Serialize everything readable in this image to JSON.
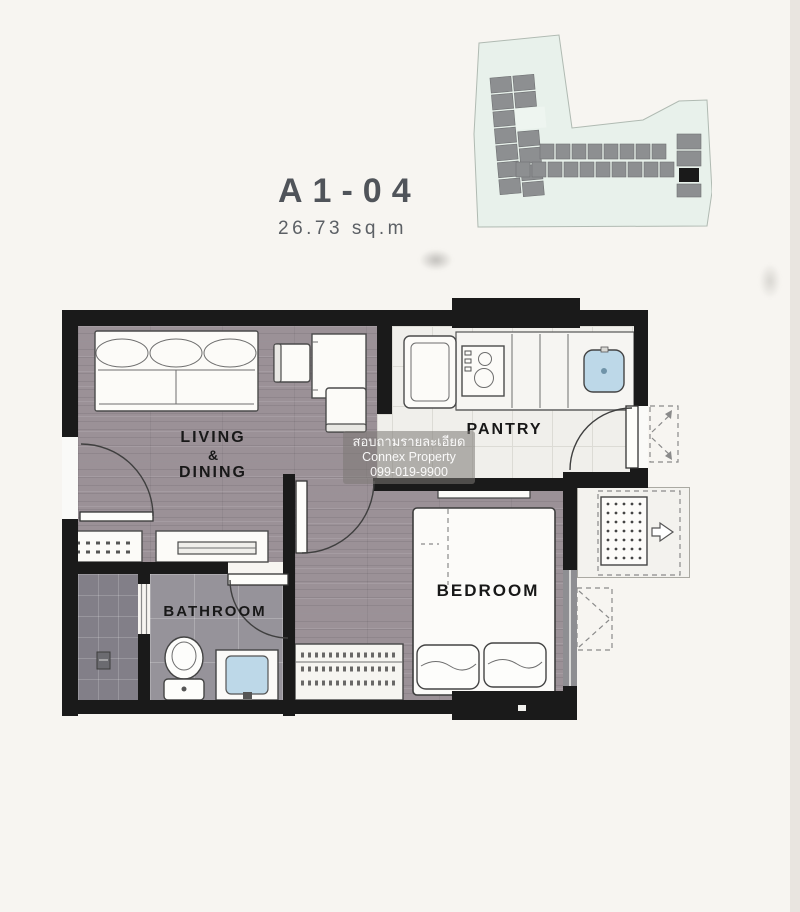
{
  "unit": {
    "code": "A1-04",
    "area": "26.73 sq.m"
  },
  "rooms": {
    "living": {
      "lines": [
        "LIVING",
        "&",
        "DINING"
      ]
    },
    "pantry": {
      "label": "PANTRY"
    },
    "bedroom": {
      "label": "BEDROOM"
    },
    "bathroom": {
      "label": "BATHROOM"
    }
  },
  "watermark": {
    "lines": [
      "สอบถามรายละเอียด",
      "Connex Property",
      "099-019-9900"
    ]
  },
  "palette": {
    "wall": "#1a1a1a",
    "wood_floor": "#9b9197",
    "bath_floor": "#96939a",
    "shower_floor": "#827f88",
    "pantry_floor": "#f0efeb",
    "sink_blue": "#bdd8e8",
    "site_fill": "#e8f1eb",
    "site_building": "#8d8f91",
    "title_text": "#50545a"
  }
}
